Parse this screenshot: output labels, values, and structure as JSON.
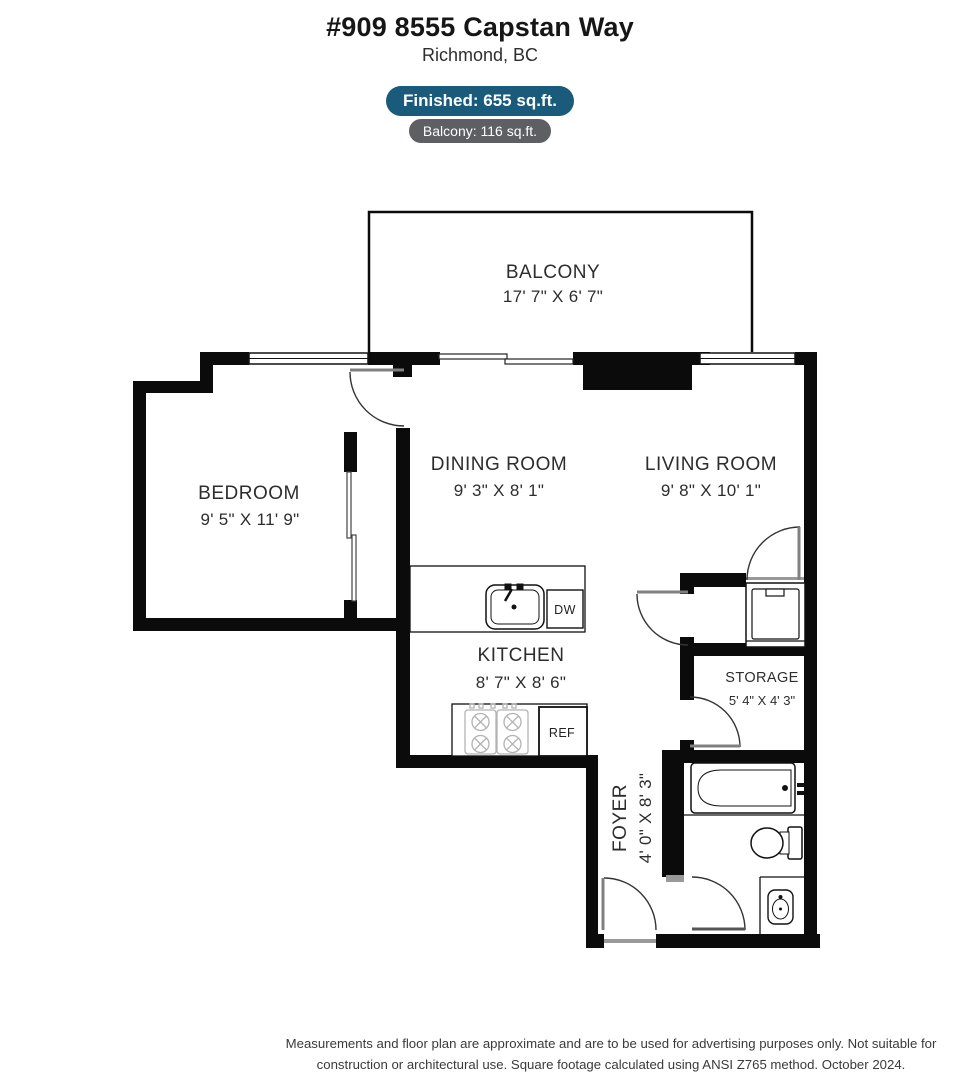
{
  "header": {
    "title": "#909 8555 Capstan Way",
    "subtitle": "Richmond, BC",
    "finished_badge": "Finished: 655 sq.ft.",
    "balcony_badge": "Balcony: 116 sq.ft.",
    "finished_badge_color": "#1a5a7a",
    "balcony_badge_color": "#5d5f62"
  },
  "rooms": {
    "balcony": {
      "name": "BALCONY",
      "dims": "17' 7\" X 6' 7\""
    },
    "bedroom": {
      "name": "BEDROOM",
      "dims": "9' 5\" X 11' 9\""
    },
    "dining": {
      "name": "DINING ROOM",
      "dims": "9' 3\" X 8' 1\""
    },
    "living": {
      "name": "LIVING ROOM",
      "dims": "9' 8\" X 10' 1\""
    },
    "kitchen": {
      "name": "KITCHEN",
      "dims": "8' 7\" X 8' 6\""
    },
    "storage": {
      "name": "STORAGE",
      "dims": "5' 4\" X 4' 3\""
    },
    "foyer": {
      "name": "FOYER",
      "dims": "4' 0\" X 8' 3\""
    }
  },
  "appliances": {
    "dishwasher": "DW",
    "refrigerator": "REF"
  },
  "colors": {
    "wall": "#0b0b0b"
  },
  "footer": {
    "line1": "Measurements and floor plan are approximate and are to be used for advertising purposes only. Not suitable for",
    "line2": "construction or architectural use. Square footage calculated using ANSI Z765 method. October 2024."
  }
}
